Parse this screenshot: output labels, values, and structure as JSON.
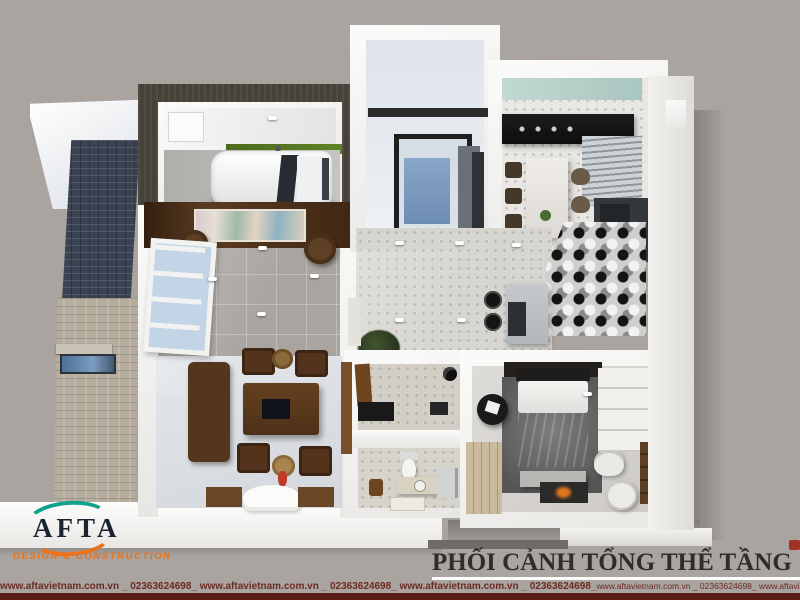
{
  "page": {
    "background_color": "#a9a4a0"
  },
  "branding": {
    "logo_text": "AFTA",
    "tagline": "DESIGN & CONSTRUCTION",
    "logo_text_color": "#1b2330",
    "arc_top_color": "#0fa38c",
    "arc_bottom_color": "#e8731a",
    "tagline_color": "#e8731a"
  },
  "caption": {
    "title": "PHỐI CẢNH TỔNG THỂ TẦNG 1",
    "color": "#2f2d2a"
  },
  "footer": {
    "marquee_bold": "www.aftavietnam.com.vn _ 02363624698_ www.aftavietnam.com.vn _ 02363624698_ www.aftavietnam.com.vn _ 02363624698_",
    "marquee_regular": "www.aftavietnam.com.vn _ 02363624698_ www.aftavietnam.com.vn _ 02363624698_ www.aftavietnam.com.vn _ 02363624698",
    "text_color": "#6b2a22",
    "bar_color": "#5c1e18"
  },
  "scene_colors": {
    "backdrop": "#a9a4a0",
    "walls": "#f4f3f1",
    "garage_band": "#474239",
    "grass_strip": "#5a7b22",
    "living_floor": "#c7d1df",
    "glass": "#7d9cc2",
    "wood_dark": "#4f3118",
    "kitchen_counter": "#151515",
    "teal_ceiling": "#c2d9d3",
    "bedroom_rug": "#6f6f6f",
    "blanket": "#94a0ab"
  }
}
